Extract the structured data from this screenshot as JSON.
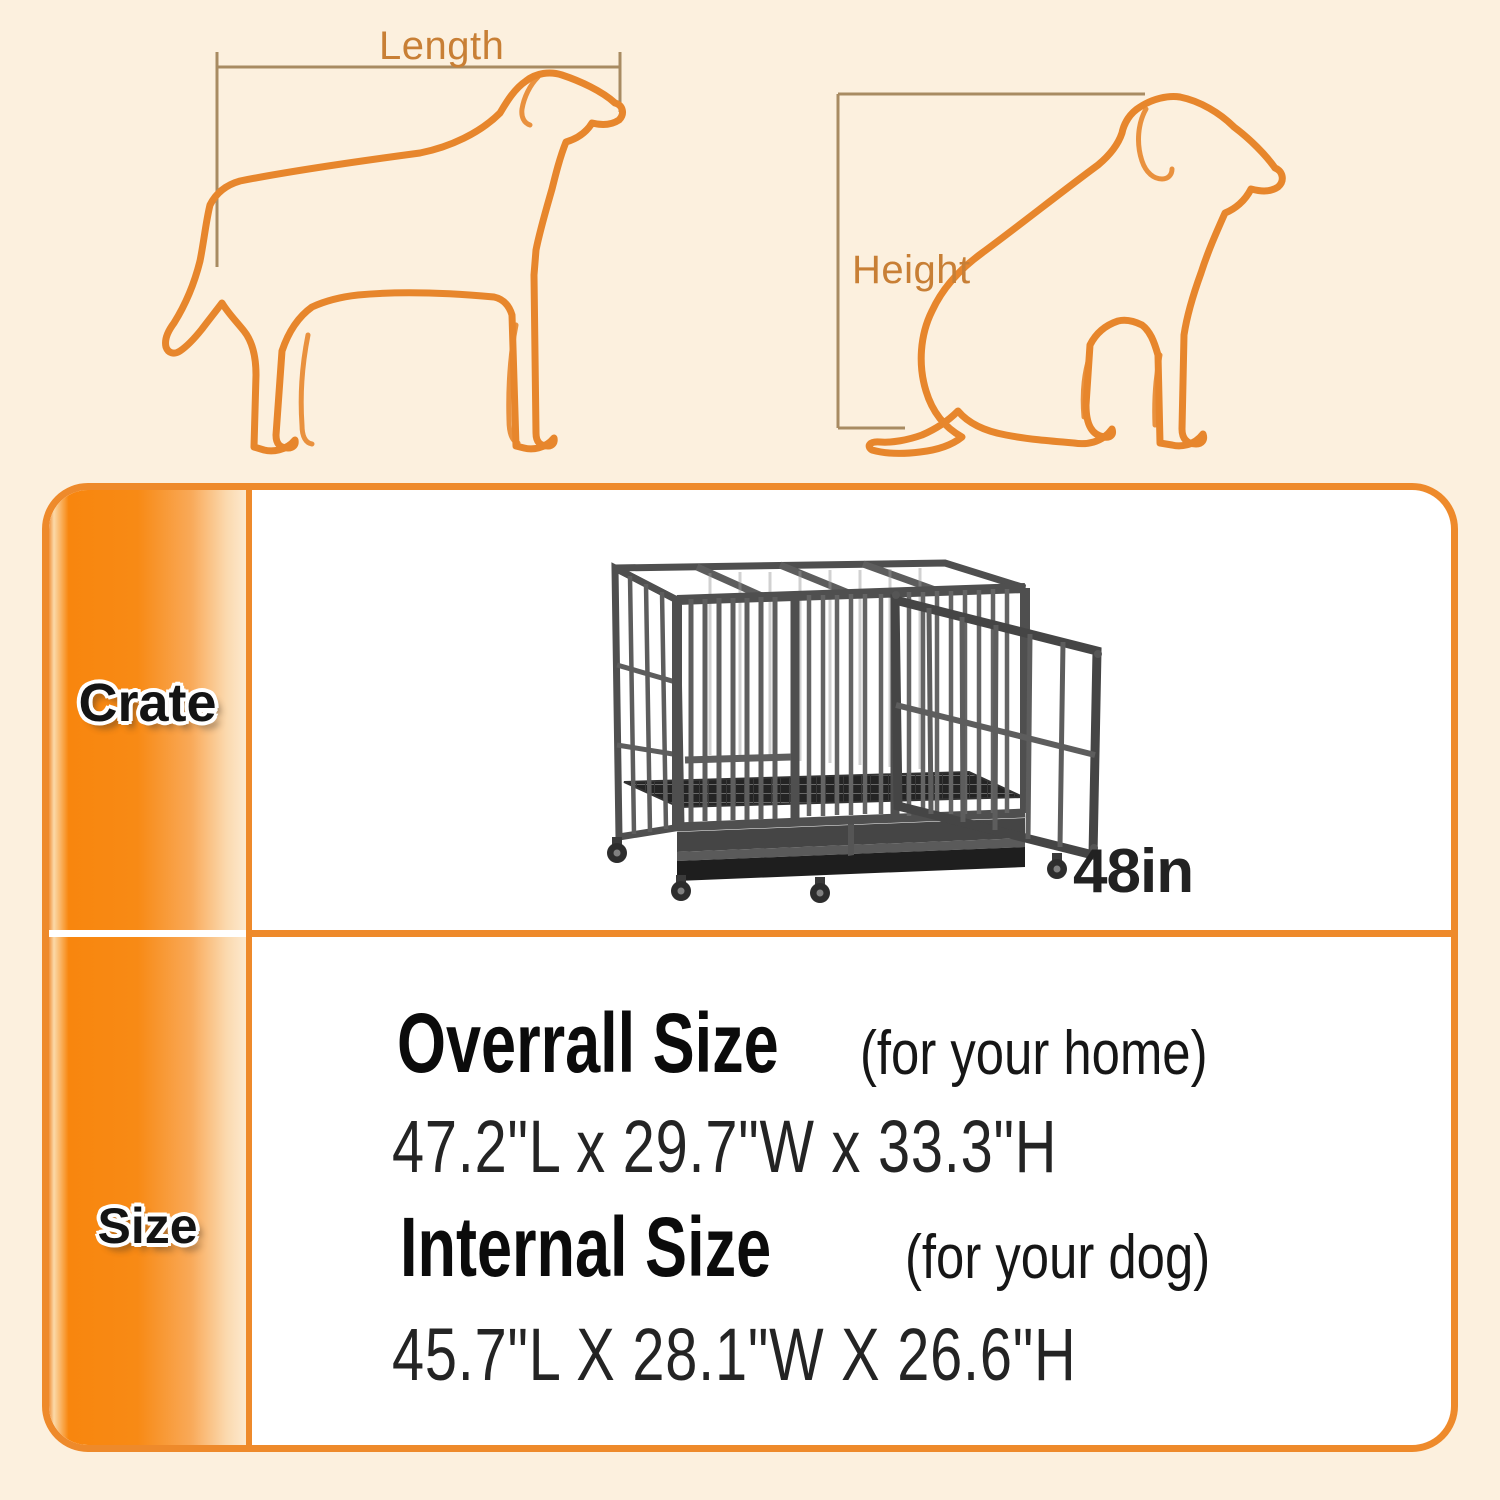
{
  "colors": {
    "bg": "#FCF0DE",
    "accent": "#EE8A2B",
    "dog_outline": "#E7862C",
    "measure_line": "#A88B62",
    "guide_label": "#C87F35",
    "heading_text": "#222222",
    "dims_text": "#242424",
    "crate_gray": "#4f4f4f"
  },
  "guide": {
    "length_label": "Length",
    "height_label": "Height"
  },
  "panel": {
    "rows": {
      "crate": {
        "label": "Crate",
        "size_callout": "48in"
      },
      "size": {
        "label": "Size",
        "overall_title": "Overrall Size",
        "overall_note": "(for your home)",
        "overall_dims": "47.2\"L x 29.7\"W x 33.3\"H",
        "internal_title": "Internal Size",
        "internal_note": "(for your dog)",
        "internal_dims": "45.7\"L X 28.1\"W X 26.6\"H"
      }
    }
  }
}
